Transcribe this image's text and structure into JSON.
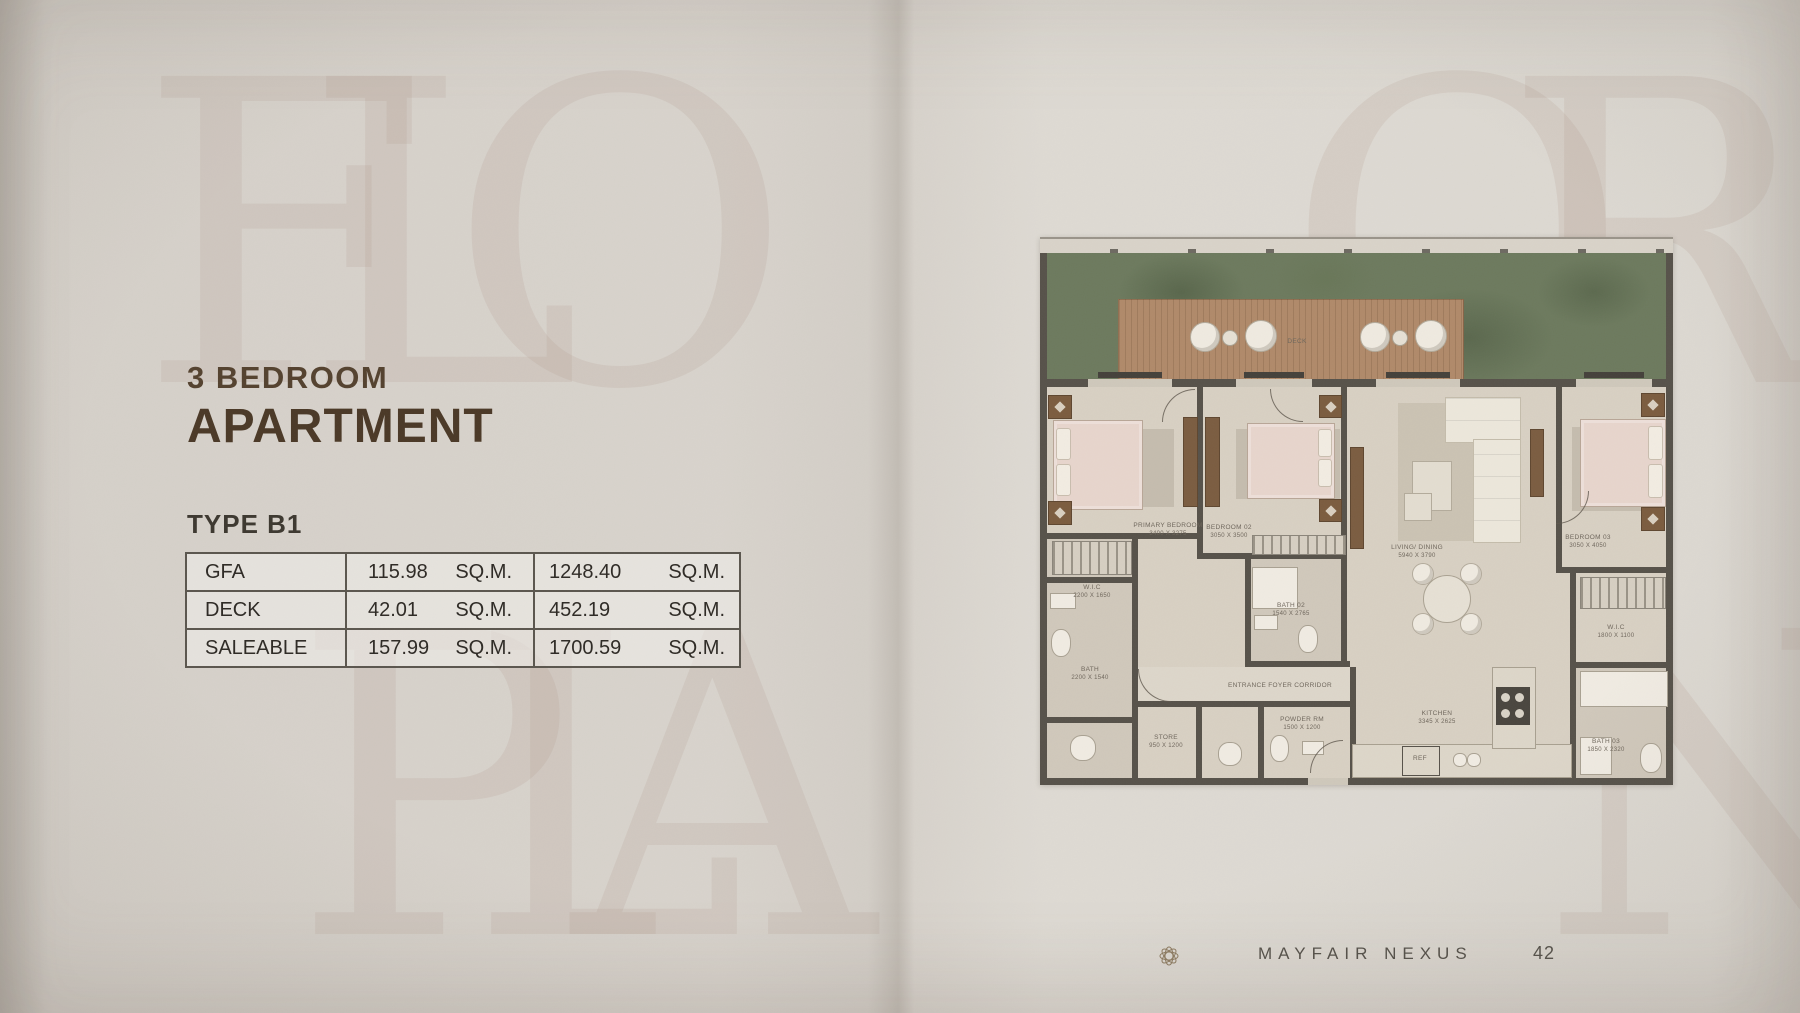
{
  "watermark": {
    "line1": "FLOOR",
    "line2": "PLAN"
  },
  "left_panel": {
    "kicker": "3 BEDROOM",
    "title": "APARTMENT",
    "type_label": "TYPE B1",
    "table": {
      "rows": [
        {
          "label": "GFA",
          "metric_value": "115.98",
          "metric_unit": "SQ.M.",
          "alt_value": "1248.40",
          "alt_unit": "SQ.M."
        },
        {
          "label": "DECK",
          "metric_value": "42.01",
          "metric_unit": "SQ.M.",
          "alt_value": "452.19",
          "alt_unit": "SQ.M."
        },
        {
          "label": "SALEABLE",
          "metric_value": "157.99",
          "metric_unit": "SQ.M.",
          "alt_value": "1700.59",
          "alt_unit": "SQ.M."
        }
      ]
    }
  },
  "floorplan": {
    "deck_label": "DECK",
    "rooms": [
      {
        "name": "PRIMARY BEDROOM",
        "dims": "3400 x 3275"
      },
      {
        "name": "BEDROOM 02",
        "dims": "3050 x 3500"
      },
      {
        "name": "LIVING/ DINING",
        "dims": "5940 x 3790"
      },
      {
        "name": "BEDROOM 03",
        "dims": "3050 x 4050"
      },
      {
        "name": "W.I.C",
        "dims": "2200 x 1650"
      },
      {
        "name": "BATH",
        "dims": "2200 x 1540"
      },
      {
        "name": "STORE",
        "dims": "950 x 1200"
      },
      {
        "name": "POWDER RM",
        "dims": "1500 x 1200"
      },
      {
        "name": "ENTRANCE FOYER CORRIDOR",
        "dims": ""
      },
      {
        "name": "BATH 02",
        "dims": "1540 x 2765"
      },
      {
        "name": "KITCHEN",
        "dims": "3345 x 2625"
      },
      {
        "name": "REF",
        "dims": ""
      },
      {
        "name": "W.I.C",
        "dims": "1800 x 1100"
      },
      {
        "name": "BATH 03",
        "dims": "1850 x 2320"
      }
    ]
  },
  "footer": {
    "logo_icon": "rosette-icon",
    "brand": "MAYFAIR NEXUS",
    "page_number": "42"
  },
  "colors": {
    "paper": "#d8d3cc",
    "accent_brown": "#4b3927",
    "wall": "#57524a",
    "garden_green": "#6d7a5e",
    "deck_wood": "#b08a6a",
    "bed_pink": "#e7d5cc"
  }
}
